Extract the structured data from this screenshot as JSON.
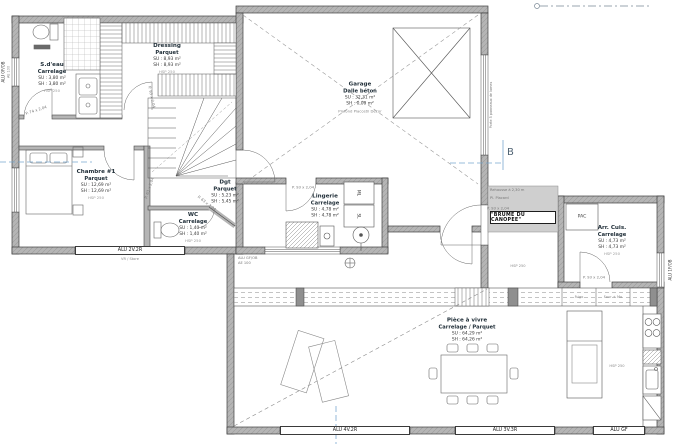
{
  "colors": {
    "background": "#ffffff",
    "wall_fill": "#b5b5b5",
    "wall_line": "#3f3f3f",
    "section_blue": "#7aa9cf",
    "muted_text": "#8a8a8a"
  },
  "rooms": {
    "sdeau": {
      "name": "S.d'eau",
      "finish": "Carrelage",
      "su": "SU : 3,80 m²",
      "sh": "SH : 3,80 m²",
      "hsp": "HSP 250"
    },
    "dressing": {
      "name": "Dressing",
      "finish": "Parquet",
      "su": "SU : 8,93 m²",
      "sh": "SH : 8,93 m²",
      "hsp": "HSP 250"
    },
    "chambre": {
      "name": "Chambre #1",
      "finish": "Parquet",
      "su": "SU : 12,69 m²",
      "sh": "SH : 12,69 m²",
      "hsp": "HSP 250"
    },
    "dgt": {
      "name": "Dgt",
      "finish": "Parquet",
      "su": "SU : 5,23 m²",
      "sh": "SH : 5,45 m²",
      "hsp": "HSP 250"
    },
    "wc": {
      "name": "WC",
      "finish": "Carrelage",
      "su": "SU : 1,40 m²",
      "sh": "SH : 1,40 m²",
      "hsp": "HSP 250"
    },
    "garage": {
      "name": "Garage",
      "finish": "Dalle béton",
      "su": "SU : 32,31 m²",
      "sh": "SH : 0,00 m²",
      "note": "Plafond Placostil Décor"
    },
    "lingerie": {
      "name": "Lingerie",
      "finish": "Carrelage",
      "su": "SU : 4,78 m²",
      "sh": "SH : 4,78 m²",
      "hsp": "HSP 250"
    },
    "arrcuis": {
      "name": "Arr. Cuis.",
      "finish": "Carrelage",
      "su": "SU : 4,73 m²",
      "sh": "SH : 4,73 m²",
      "hsp": "HSP 250"
    },
    "piece": {
      "name": "Pièce à vivre",
      "finish": "Carrelage / Parquet",
      "su": "SU : 64,29 m²",
      "sh": "SH : 64,26 m²",
      "hsp": "HSP 250"
    }
  },
  "windows": {
    "left_top": "ALU 0F/OB",
    "left_top_sub": "AE 100",
    "chambre": "ALU 2V.2R",
    "chambre_sub": "VR / Store",
    "lingerie": "ALU GF/OB",
    "lingerie_sub": "AE 100",
    "bottom_left": "ALU 4V.2R",
    "bottom_center": "ALU 3V.3R",
    "bottom_right": "ALU GF",
    "right": "ALU 1F/OB"
  },
  "doors": {
    "p93": "P. 93 x 2,04",
    "p74": "P. 74 x 2,04",
    "p63": "P. 63 x 2,04"
  },
  "labels": {
    "section_b": "B",
    "pac": "PAC",
    "ml": "ML",
    "sl": "SL",
    "frigo": "Frigo",
    "four_mo": "Four + Mo",
    "brume": "\"BRUME DU CANOPEE\"",
    "rehausse": "Rehausse à 2,30 m",
    "placard": "Pl. Placard",
    "garage_door": "Porte 5 panneaux de lames",
    "hsp": "HSP 250"
  }
}
